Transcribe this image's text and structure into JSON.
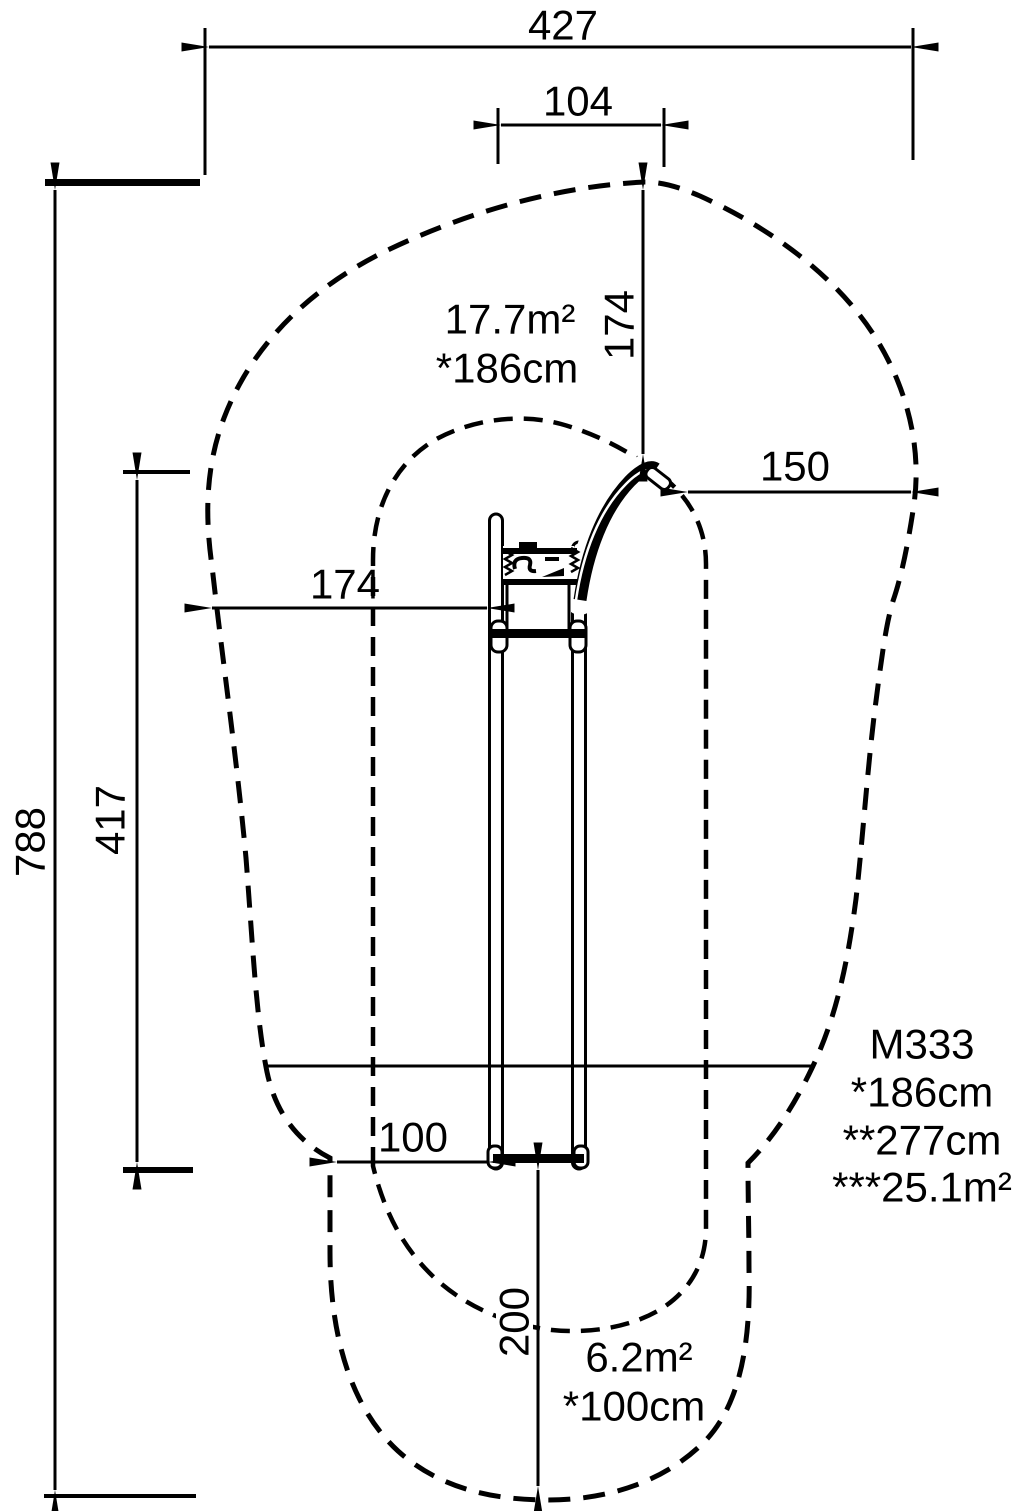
{
  "drawing": {
    "dimensions": {
      "total_width": "427",
      "slide_top_width": "104",
      "top_clearance": "174",
      "right_clearance": "150",
      "left_clearance": "174",
      "total_length": "788",
      "structure_length": "417",
      "slide_end_width": "100",
      "runout_length": "200"
    },
    "zones": {
      "upper": {
        "area": "17.7m²",
        "fall_height": "*186cm"
      },
      "lower": {
        "area": "6.2m²",
        "fall_height": "*100cm"
      }
    },
    "product": {
      "model": "M333",
      "spec1": "*186cm",
      "spec2": "**277cm",
      "spec3": "***25.1m²"
    }
  }
}
